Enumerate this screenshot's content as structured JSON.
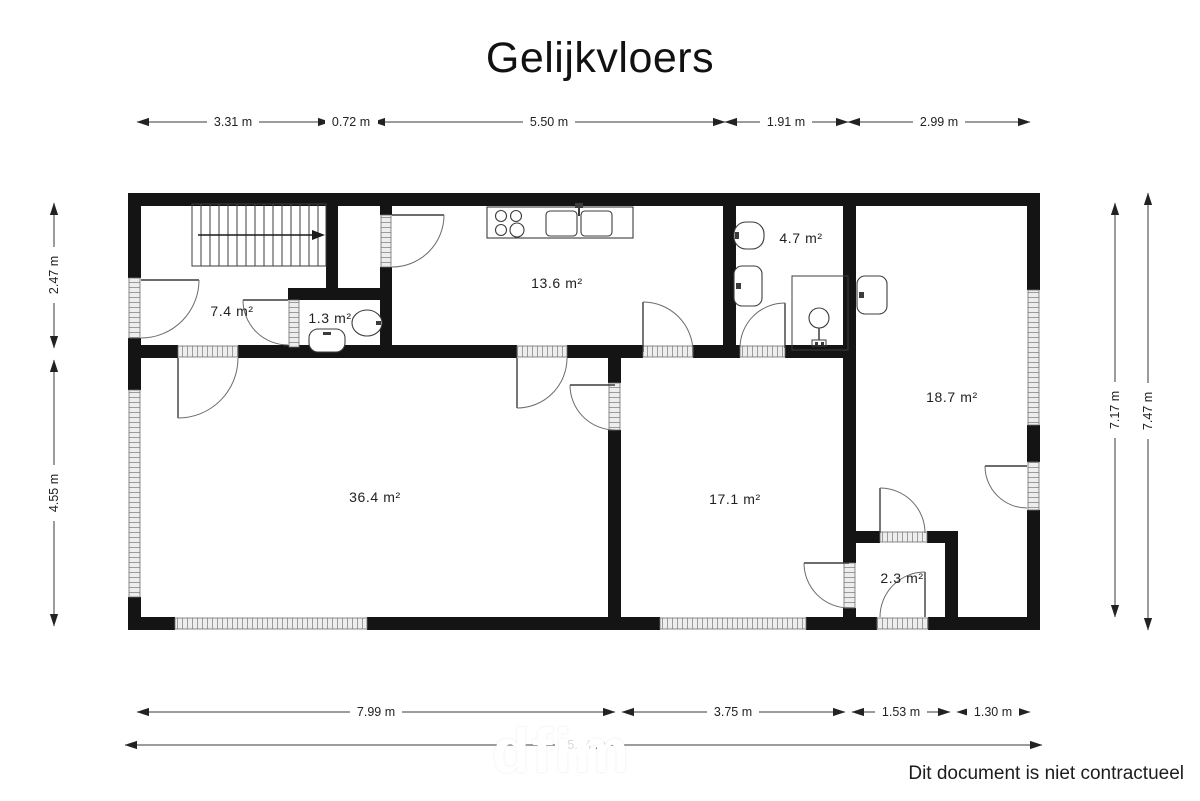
{
  "title": "Gelijkvloers",
  "footer": {
    "disclaimer": "Dit document is niet contractueel"
  },
  "watermark": {
    "text": "dfim"
  },
  "dimensions": {
    "top": [
      "3.31 m",
      "0.72 m",
      "5.50 m",
      "1.91 m",
      "2.99 m"
    ],
    "bottom": [
      "7.99 m",
      "3.75 m",
      "1.53 m",
      "1.30 m"
    ],
    "total": "15.64 m",
    "left": [
      "2.47 m",
      "4.55 m"
    ],
    "right": [
      "7.17 m",
      "7.47 m"
    ]
  },
  "rooms": [
    {
      "id": "hall",
      "area": "7.4 m²"
    },
    {
      "id": "wc",
      "area": "1.3 m²"
    },
    {
      "id": "kitchen",
      "area": "13.6 m²"
    },
    {
      "id": "bathroom",
      "area": "4.7 m²"
    },
    {
      "id": "garage",
      "area": "18.7 m²"
    },
    {
      "id": "living",
      "area": "36.4 m²"
    },
    {
      "id": "room",
      "area": "17.1 m²"
    },
    {
      "id": "vestibule",
      "area": "2.3 m²"
    }
  ],
  "icons": {
    "staircase": "stairs-with-direction-arrow",
    "stove": "four-burner-stove",
    "kitchen_sink": "double-sink-with-faucet",
    "toilet": "toilet-top-view",
    "washbasin": "washbasin-top-view",
    "shower": "shower-enclosure"
  }
}
